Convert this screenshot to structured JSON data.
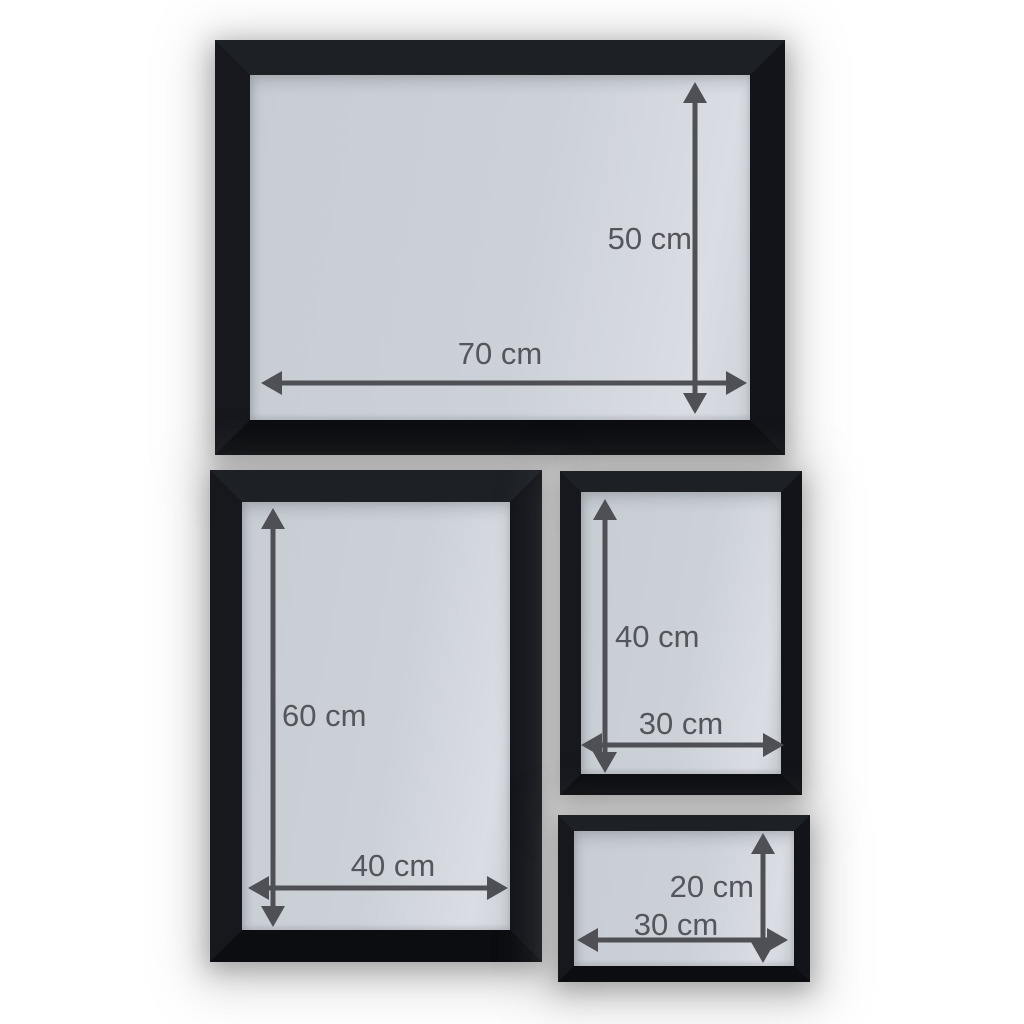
{
  "theme": {
    "page-bg": "#ffffff",
    "frame-color": "#15171b",
    "glass-color": "#ccd1d8",
    "arrow-color": "#4f5055",
    "label-color": "#55565b"
  },
  "frames": [
    {
      "height_label": "50 cm",
      "width_label": "70 cm"
    },
    {
      "height_label": "60 cm",
      "width_label": "40 cm"
    },
    {
      "height_label": "40 cm",
      "width_label": "30 cm"
    },
    {
      "height_label": "20 cm",
      "width_label": "30 cm"
    }
  ]
}
